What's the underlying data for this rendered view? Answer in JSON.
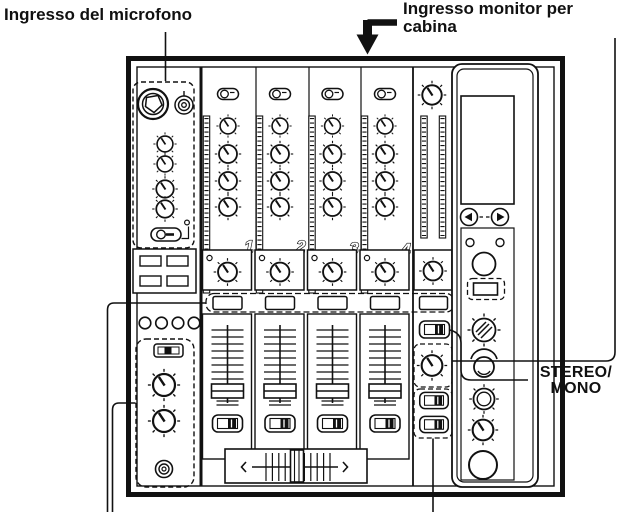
{
  "labels": {
    "mic_input": "Ingresso del microfono",
    "booth_line1": "Ingresso monitor per",
    "booth_line2": "cabina",
    "stereo_line1": "STEREO/",
    "stereo_line2": "MONO"
  },
  "channels": [
    {
      "number": "1"
    },
    {
      "number": "2"
    },
    {
      "number": "3"
    },
    {
      "number": "4"
    }
  ],
  "colors": {
    "ink": "#111111",
    "paper": "#ffffff"
  }
}
